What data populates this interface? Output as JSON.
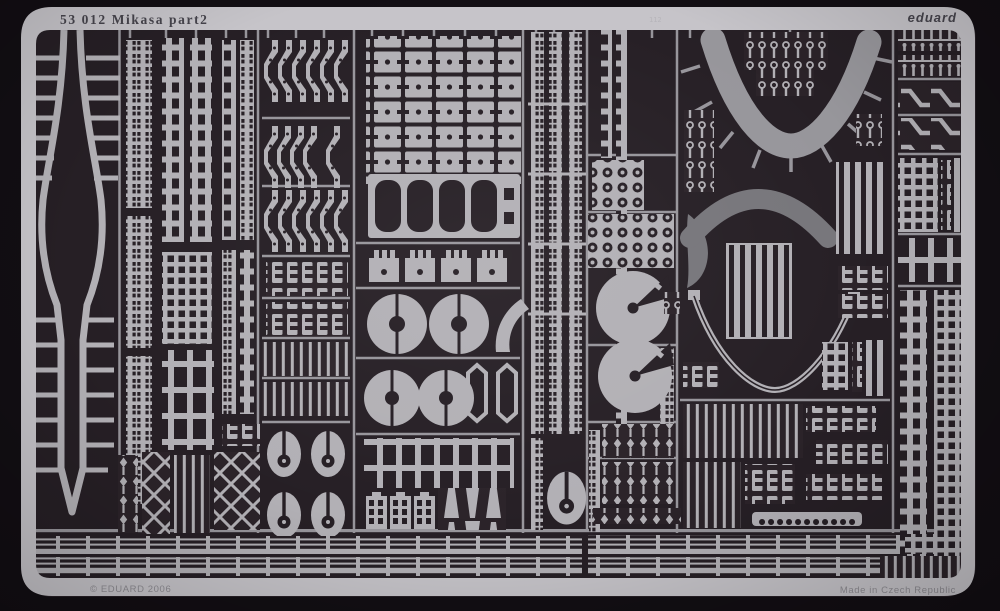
{
  "sheet": {
    "catalog_number": "53 012",
    "kit_name": "Mikasa",
    "sheet_label": "part2",
    "title_text": "53 012  Mikasa  part2",
    "brand": "eduard",
    "copyright": "© EDUARD 2006",
    "made_in": "Made in Czech Republic"
  },
  "labels": {
    "part_112": "112"
  },
  "colors": {
    "photo-bg": "#120e13",
    "field": "#261f25",
    "field-2": "#2b2329",
    "metal": "#b2b0b5",
    "metal-bright": "#c6c4c9",
    "metal-dim": "#97959b",
    "gray-part": "#97969b",
    "gray-dark-part": "#77767b",
    "etch-text": "#46444c",
    "etch-text-soft": "#8e8c92",
    "tiny-label": "#b7b5ba"
  }
}
